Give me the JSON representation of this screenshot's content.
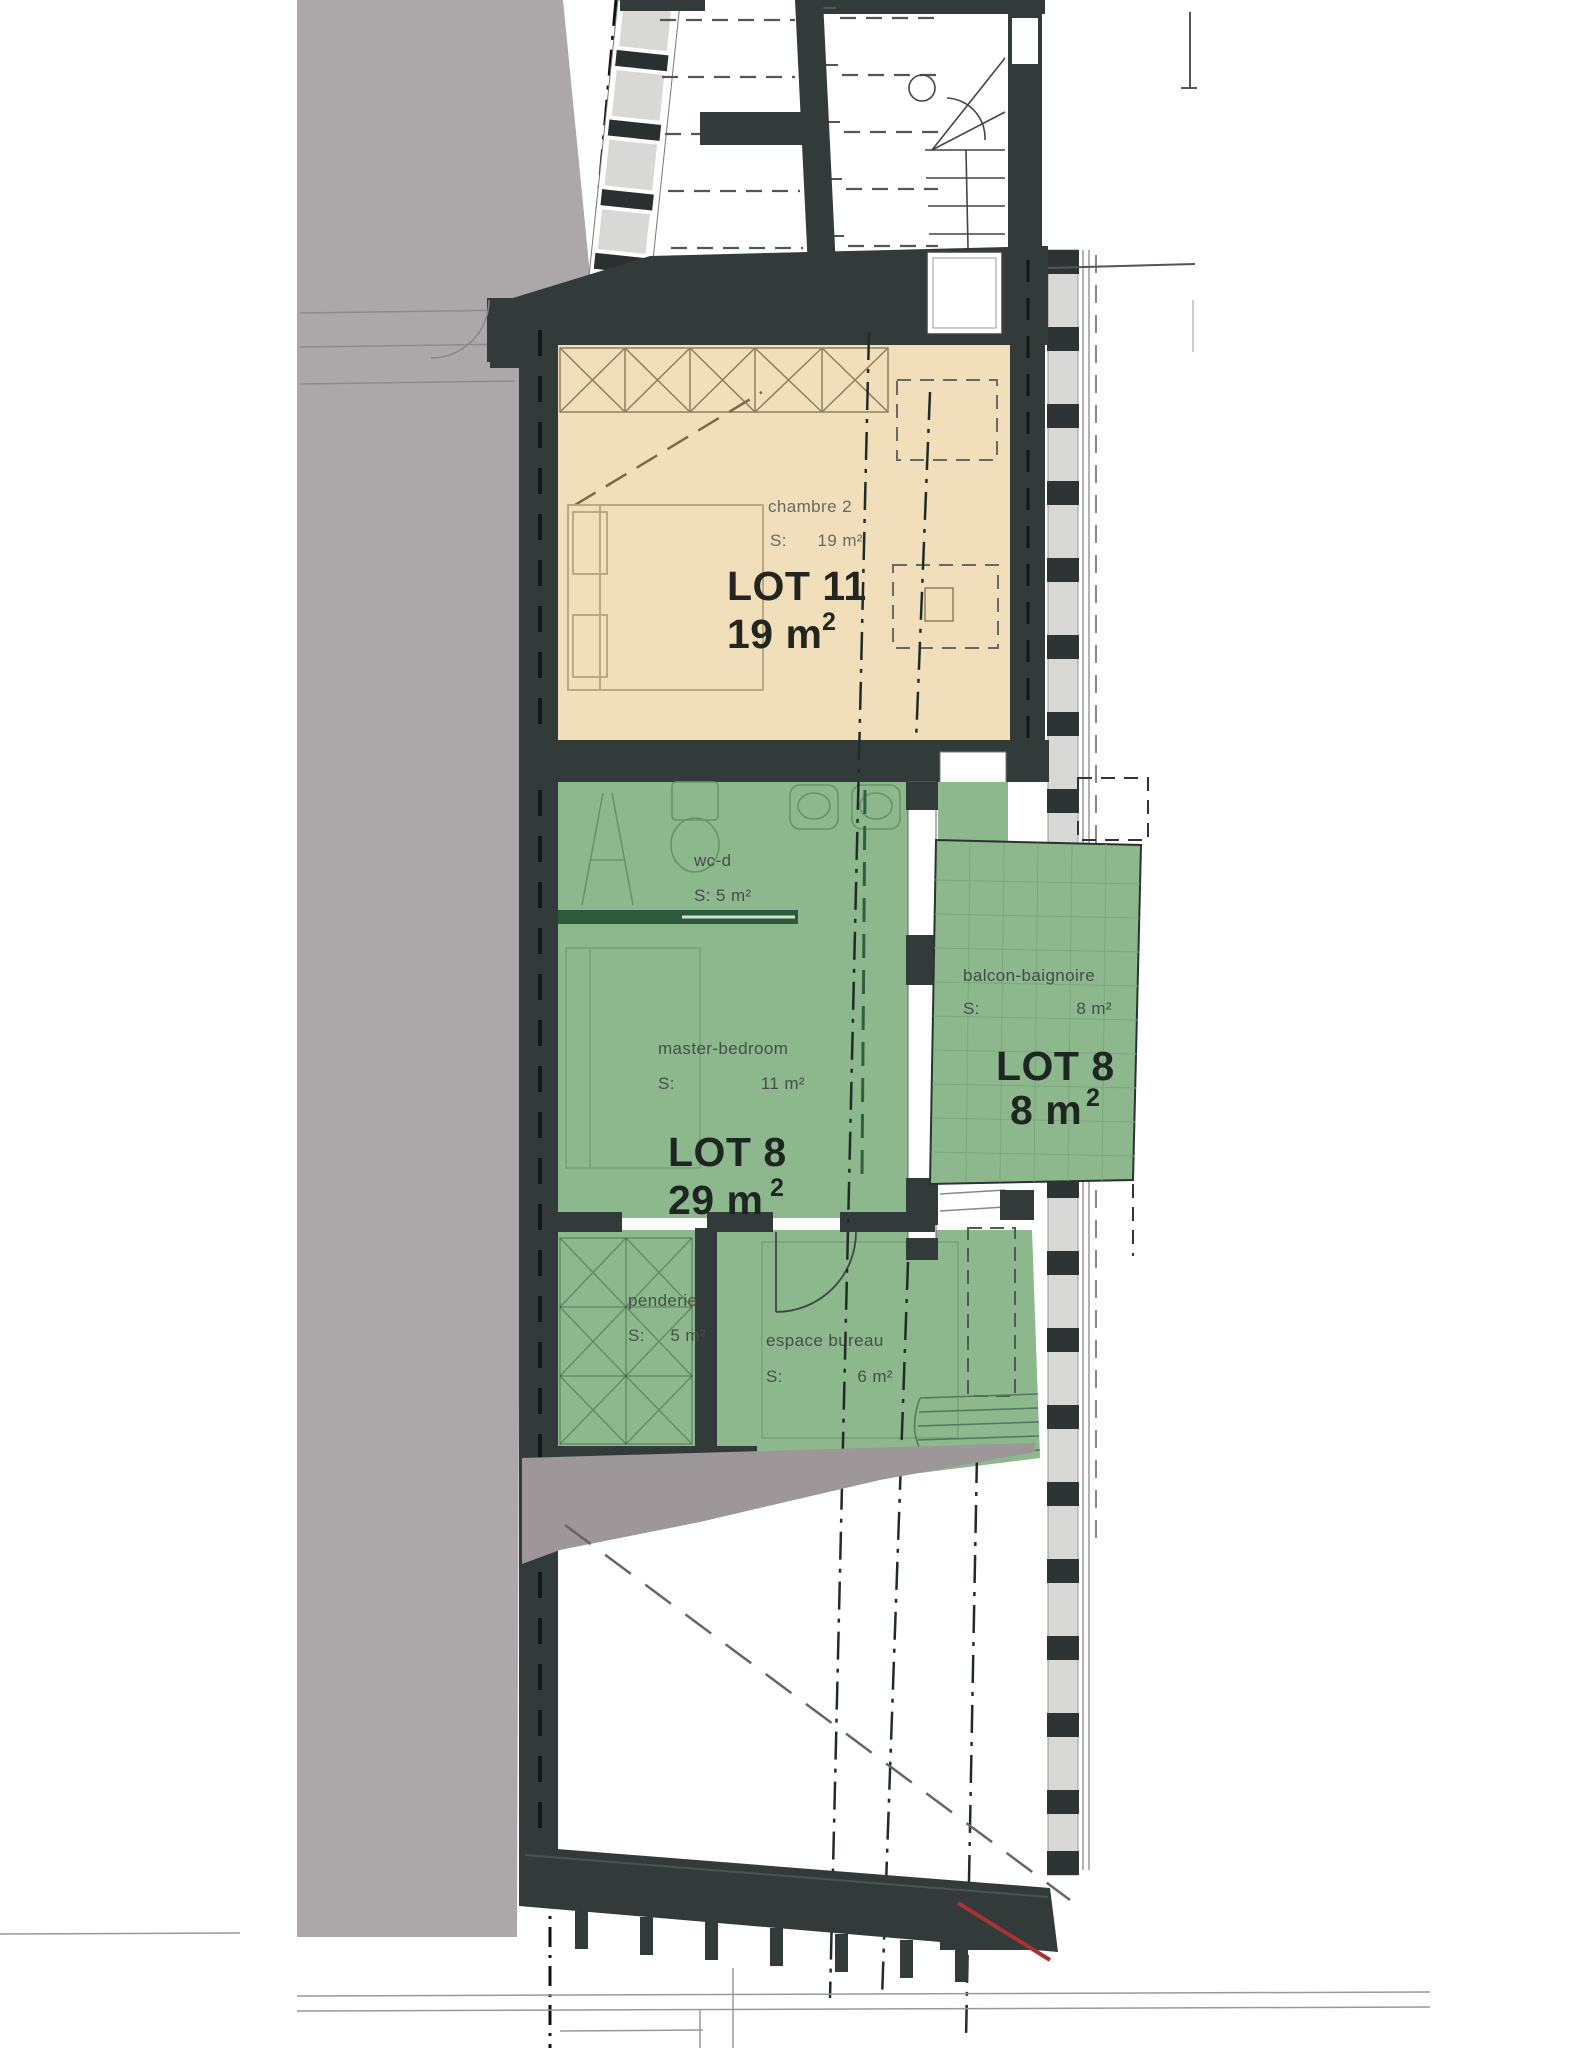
{
  "rooms": {
    "lot11": {
      "name": "chambre 2",
      "surface_label": "S:",
      "surface_value": "19 m²",
      "lot_label": "LOT 11",
      "area_main": "19 m",
      "area_sup": "2"
    },
    "wc": {
      "name": "wc-d",
      "surface": "S: 5 m²"
    },
    "master": {
      "name": "master-bedroom",
      "surface_label": "S:",
      "surface_value": "11 m²"
    },
    "lot8_main": {
      "lot_label": "LOT 8",
      "area_main": "29 m",
      "area_sup": "2"
    },
    "penderie": {
      "name": "penderie",
      "surface_label": "S:",
      "surface_value": "5 m²"
    },
    "bureau": {
      "name": "espace bureau",
      "surface_label": "S:",
      "surface_value": "6 m²"
    },
    "balcony": {
      "name": "balcon-baignoire",
      "surface_label": "S:",
      "surface_value": "8 m²",
      "lot_label": "LOT 8",
      "area_main": "8 m",
      "area_sup": "2"
    }
  },
  "colors": {
    "wall_dark": "#333A3A",
    "lot11_fill": "#F0DFBA",
    "lot8_fill": "#8DB88D",
    "neighbor_gray": "#ACA7A9",
    "inner_gray": "#9D979A",
    "panel_gray": "#D8D8D6",
    "partition_green": "#2C5B3B",
    "marker_red": "#A83232"
  }
}
